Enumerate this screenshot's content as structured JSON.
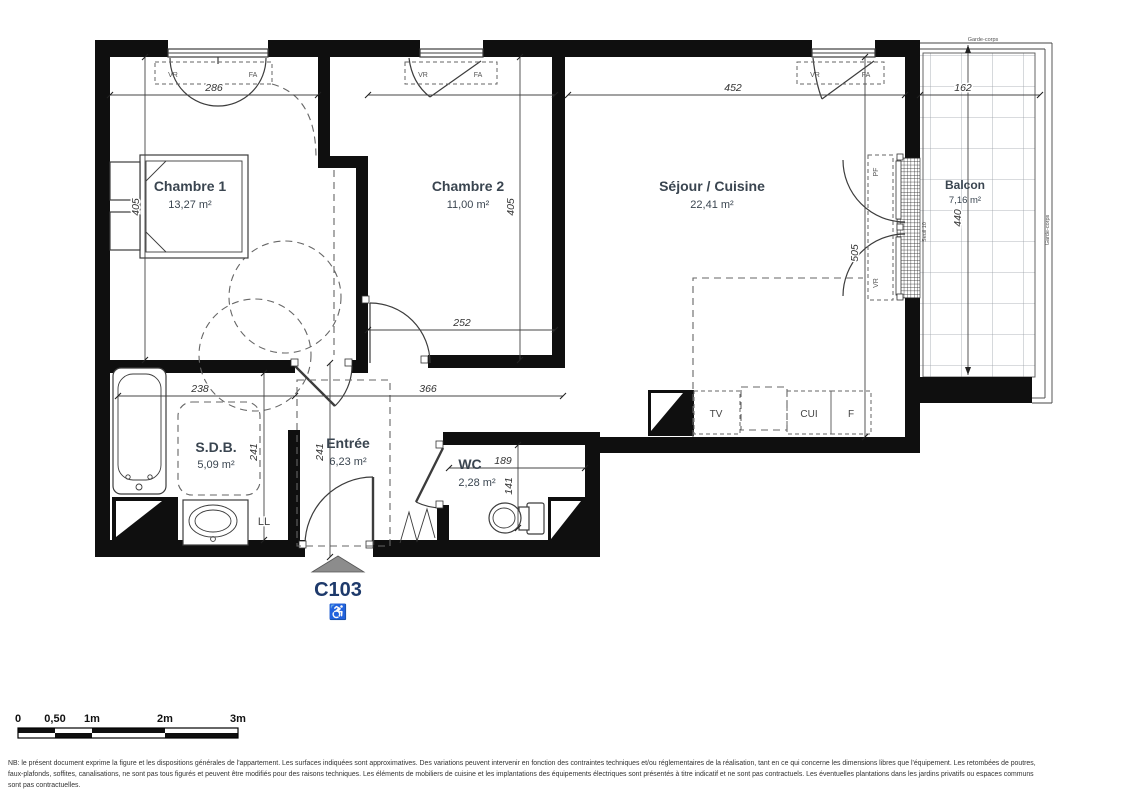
{
  "plan": {
    "unit_code": "C103",
    "rooms": [
      {
        "name": "Chambre 1",
        "area": "13,27 m²"
      },
      {
        "name": "Chambre 2",
        "area": "11,00 m²"
      },
      {
        "name": "Séjour / Cuisine",
        "area": "22,41 m²"
      },
      {
        "name": "Balcon",
        "area": "7,16 m²"
      },
      {
        "name": "S.D.B.",
        "area": "5,09 m²"
      },
      {
        "name": "Entrée",
        "area": "6,23 m²"
      },
      {
        "name": "WC",
        "area": "2,28 m²"
      }
    ],
    "dimensions_cm": {
      "chambre1_width": "286",
      "chambre1_depth": "405",
      "chambre2_width": "252",
      "chambre2_depth": "405",
      "sejour_width": "452",
      "sejour_depth": "505",
      "balcon_width": "162",
      "balcon_depth": "440",
      "sdb_width": "238",
      "sdb_depth": "241",
      "entree_width": "366",
      "entree_depth": "241",
      "wc_width": "189",
      "wc_depth": "141"
    },
    "annotations": {
      "vr": "VR",
      "fa": "FA",
      "pf": "PF",
      "seuil": "Seuil 10",
      "garde_corps": "Garde-corps",
      "tv": "TV",
      "cui": "CUI",
      "f": "F",
      "ll": "LL",
      "accessibility": "♿"
    },
    "colors": {
      "wall": "#0f0f0f",
      "room_label": "#3a4550",
      "unit_code": "#1e3a6b"
    }
  },
  "scale_bar": {
    "labels": [
      "0",
      "0,50",
      "1m",
      "2m",
      "3m"
    ]
  },
  "disclaimer": {
    "line1": "NB: le présent document exprime la figure et les dispositions générales de l'appartement. Les surfaces indiquées sont approximatives. Des variations peuvent intervenir en fonction des contraintes techniques et/ou réglementaires de la réalisation, tant en ce qui concerne les dimensions libres que l'équipement. Les retombées de poutres,",
    "line2": "faux-plafonds, soffites, canalisations, ne sont pas tous figurés et peuvent être modifiés pour des raisons techniques. Les éléments de mobiliers de cuisine et les implantations des équipements électriques sont présentés à titre indicatif et ne sont pas contractuels. Les éventuelles plantations dans les jardins privatifs ou espaces communs",
    "line3": "sont pas contractuelles."
  }
}
